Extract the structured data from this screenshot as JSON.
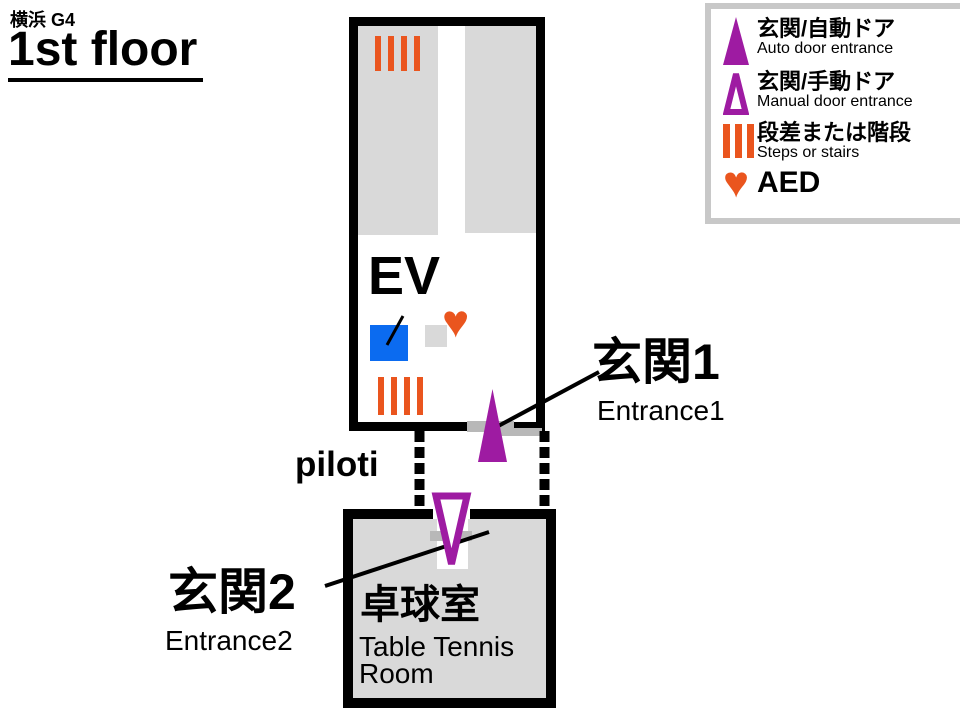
{
  "title": {
    "building": "横浜 G4",
    "floor": "1st floor"
  },
  "legend": {
    "items": [
      {
        "jp": "玄関/自動ドア",
        "en": "Auto door entrance",
        "icon": "auto-door-entrance-icon"
      },
      {
        "jp": "玄関/手動ドア",
        "en": "Manual door entrance",
        "icon": "manual-door-entrance-icon"
      },
      {
        "jp": "段差または階段",
        "en": "Steps or stairs",
        "icon": "steps-or-stairs-icon"
      },
      {
        "jp": "AED",
        "en": "",
        "icon": "aed-heart-icon"
      }
    ]
  },
  "map": {
    "elevator_label": "EV",
    "piloti_label": "piloti",
    "entrance1": {
      "jp": "玄関1",
      "en": "Entrance1"
    },
    "entrance2": {
      "jp": "玄関2",
      "en": "Entrance2"
    },
    "table_tennis_room": {
      "jp": "卓球室",
      "en": "Table Tennis Room"
    }
  },
  "colors": {
    "entrance_purple": "#9e1ba2",
    "steps_orange": "#ea551e",
    "elevator_blue": "#0b6bf0",
    "room_gray": "#d9d9d9",
    "door_gray": "#b8b8b8",
    "legend_border_gray": "#c8c8c8",
    "line_black": "#000000"
  }
}
